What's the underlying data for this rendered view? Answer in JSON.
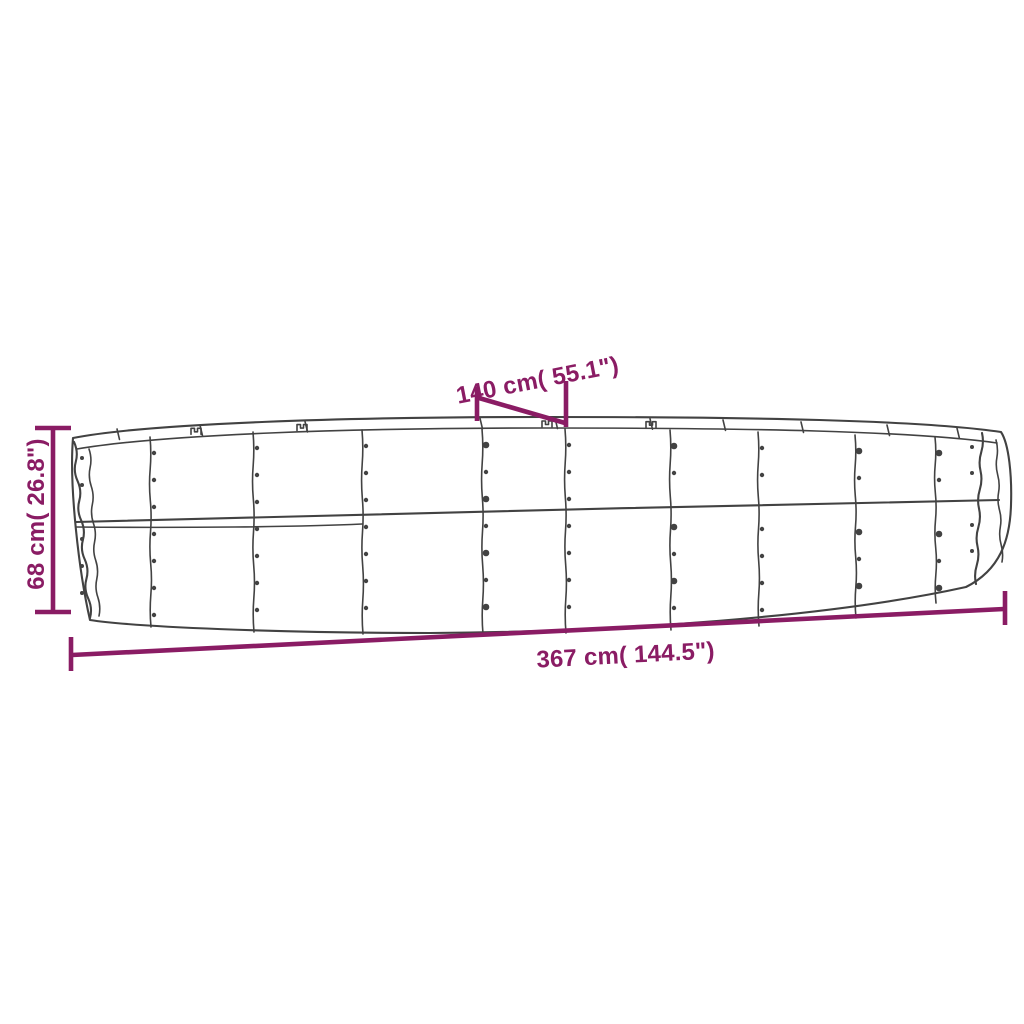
{
  "page": {
    "type": "product-dimension-diagram",
    "background_color": "#ffffff",
    "subject": "oval corrugated steel raised garden bed, line-art side view"
  },
  "colors": {
    "dimension": "#8a1c64",
    "line_art": "#424242"
  },
  "dimensions": {
    "width": {
      "label": "140 cm( 55.1\")",
      "value_cm": 140,
      "value_in": 55.1,
      "orientation": "diagonal-top"
    },
    "height": {
      "label": "68 cm( 26.8\")",
      "value_cm": 68,
      "value_in": 26.8,
      "orientation": "vertical-left"
    },
    "length": {
      "label": "367 cm( 144.5\")",
      "value_cm": 367,
      "value_in": 144.5,
      "orientation": "horizontal-bottom"
    }
  },
  "drawing": {
    "panel_rows": 2,
    "panel_seams": 9,
    "has_rivets": true,
    "corrugated_ends": true
  }
}
